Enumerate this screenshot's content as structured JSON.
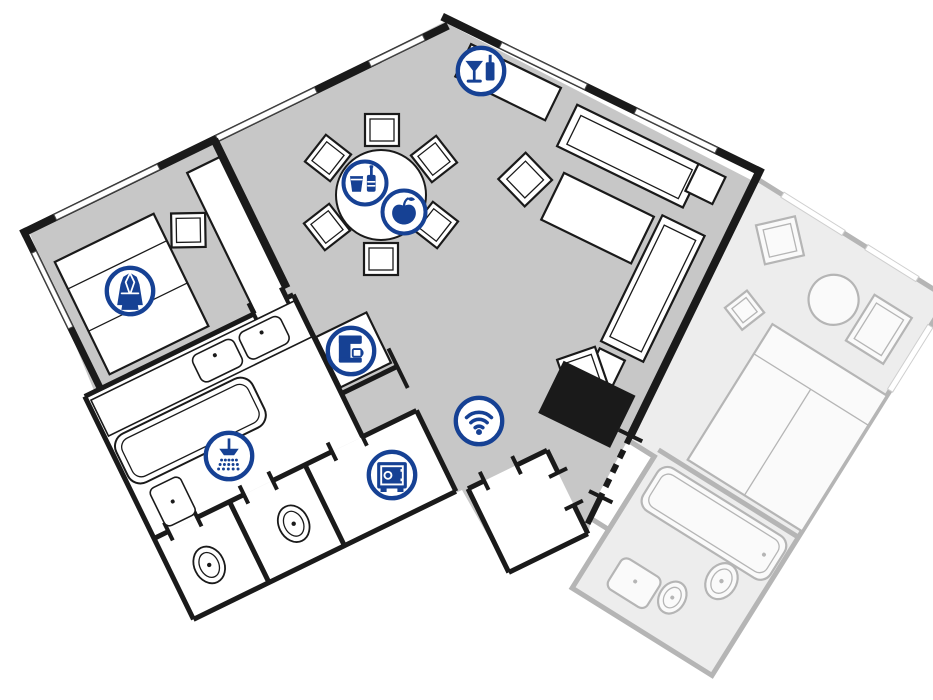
{
  "page": {
    "kind": "hotel-suite-floor-plan",
    "background": "#ffffff"
  },
  "colors": {
    "accent_blue": "#164194",
    "wall_black": "#1a1a1a",
    "main_room_floor": "#c7c7c7",
    "adjacent_room_floor": "#ededed",
    "adjacent_room_lines": "#b5b5b5",
    "furniture_fill": "#ffffff"
  },
  "rooms": {
    "main_suite": [
      "bedroom",
      "living-dining-area",
      "bathroom",
      "wc",
      "wc-2",
      "safe-closet",
      "entry-vestibule"
    ],
    "adjacent_room": [
      "bedroom",
      "bathroom",
      "entry"
    ]
  },
  "amenity_icons": [
    {
      "name": "cocktail-bar-icon",
      "sym": "bar",
      "x": 481,
      "y": 71,
      "r": 27
    },
    {
      "name": "drinks-icon",
      "sym": "drinks",
      "x": 365,
      "y": 183,
      "r": 25
    },
    {
      "name": "fruit-icon",
      "sym": "fruit",
      "x": 404,
      "y": 212,
      "r": 25
    },
    {
      "name": "bathrobe-icon",
      "sym": "robe",
      "x": 130,
      "y": 291,
      "r": 27
    },
    {
      "name": "coffee-machine-icon",
      "sym": "coffee",
      "x": 351,
      "y": 351,
      "r": 27
    },
    {
      "name": "shower-icon",
      "sym": "shower",
      "x": 229,
      "y": 456,
      "r": 27
    },
    {
      "name": "wifi-icon",
      "sym": "wifi",
      "x": 479,
      "y": 421,
      "r": 27
    },
    {
      "name": "safe-icon",
      "sym": "safe",
      "x": 392,
      "y": 475,
      "r": 27
    }
  ]
}
